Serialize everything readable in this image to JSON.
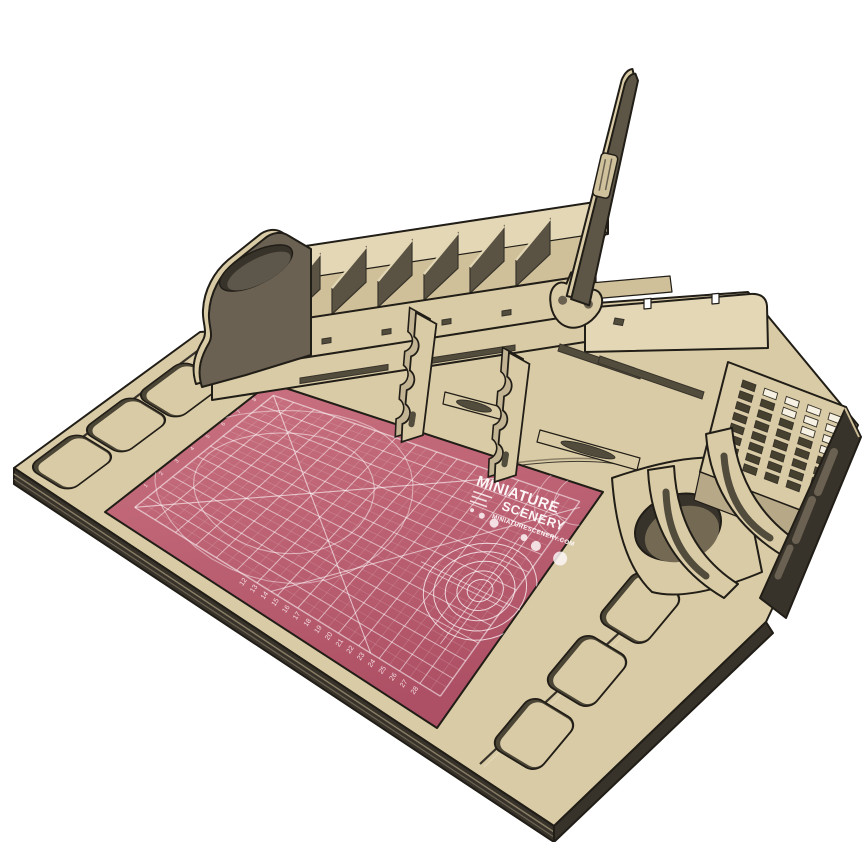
{
  "scene": {
    "description": "3D render of a laser-cut plywood hobbyist painting workstation on a white background, viewed from the front-left at an angle",
    "product": "hobby workstation organizer",
    "background": "#ffffff",
    "palette": {
      "outline": "#211d17",
      "wood_top": "#d9cba5",
      "wood_light": "#e3d7b6",
      "wood_mid": "#cfc09a",
      "wood_shadow": "#b7a988",
      "wood_side": "#6a6152",
      "wood_dark": "#524c3d",
      "edge_dark": "#38332a",
      "mat_top": "#ca7381",
      "mat_bottom": "#ae5065",
      "logo_white": "#fdf6f7"
    }
  },
  "mat": {
    "name": "self-healing cutting mat",
    "brand_line1": "MINIATURE",
    "brand_line2": "SCENERY",
    "brand_url": "MINIATURESCENERY.COM",
    "bottom_ruler_numbers": [
      "12",
      "13",
      "14",
      "15",
      "16",
      "17",
      "18",
      "19",
      "20",
      "21",
      "22",
      "23",
      "24",
      "25",
      "26",
      "27",
      "28"
    ],
    "left_ruler_numbers": [
      "1",
      "2",
      "3",
      "4",
      "5",
      "6",
      "7",
      "8"
    ],
    "grid": {
      "major_cols": 15,
      "major_rows": 11
    }
  },
  "organizer": {
    "name": "rear compartment shelf",
    "divider_count": 7
  },
  "trays": {
    "left": {
      "name": "paint trays left edge",
      "count": 3
    },
    "right": {
      "name": "paint trays right edge",
      "count": 3
    }
  },
  "rack": {
    "name": "tool slot rack",
    "rows": 8,
    "cols": 5,
    "open_slots": [
      [
        0,
        1
      ],
      [
        0,
        2
      ],
      [
        0,
        3
      ],
      [
        0,
        4
      ],
      [
        1,
        2
      ],
      [
        1,
        3
      ],
      [
        1,
        4
      ],
      [
        2,
        3
      ],
      [
        2,
        4
      ],
      [
        3,
        4
      ]
    ]
  },
  "stands": {
    "name": "clamp stands",
    "count": 2
  },
  "cup": {
    "name": "water cup holder hole",
    "count": 1
  }
}
